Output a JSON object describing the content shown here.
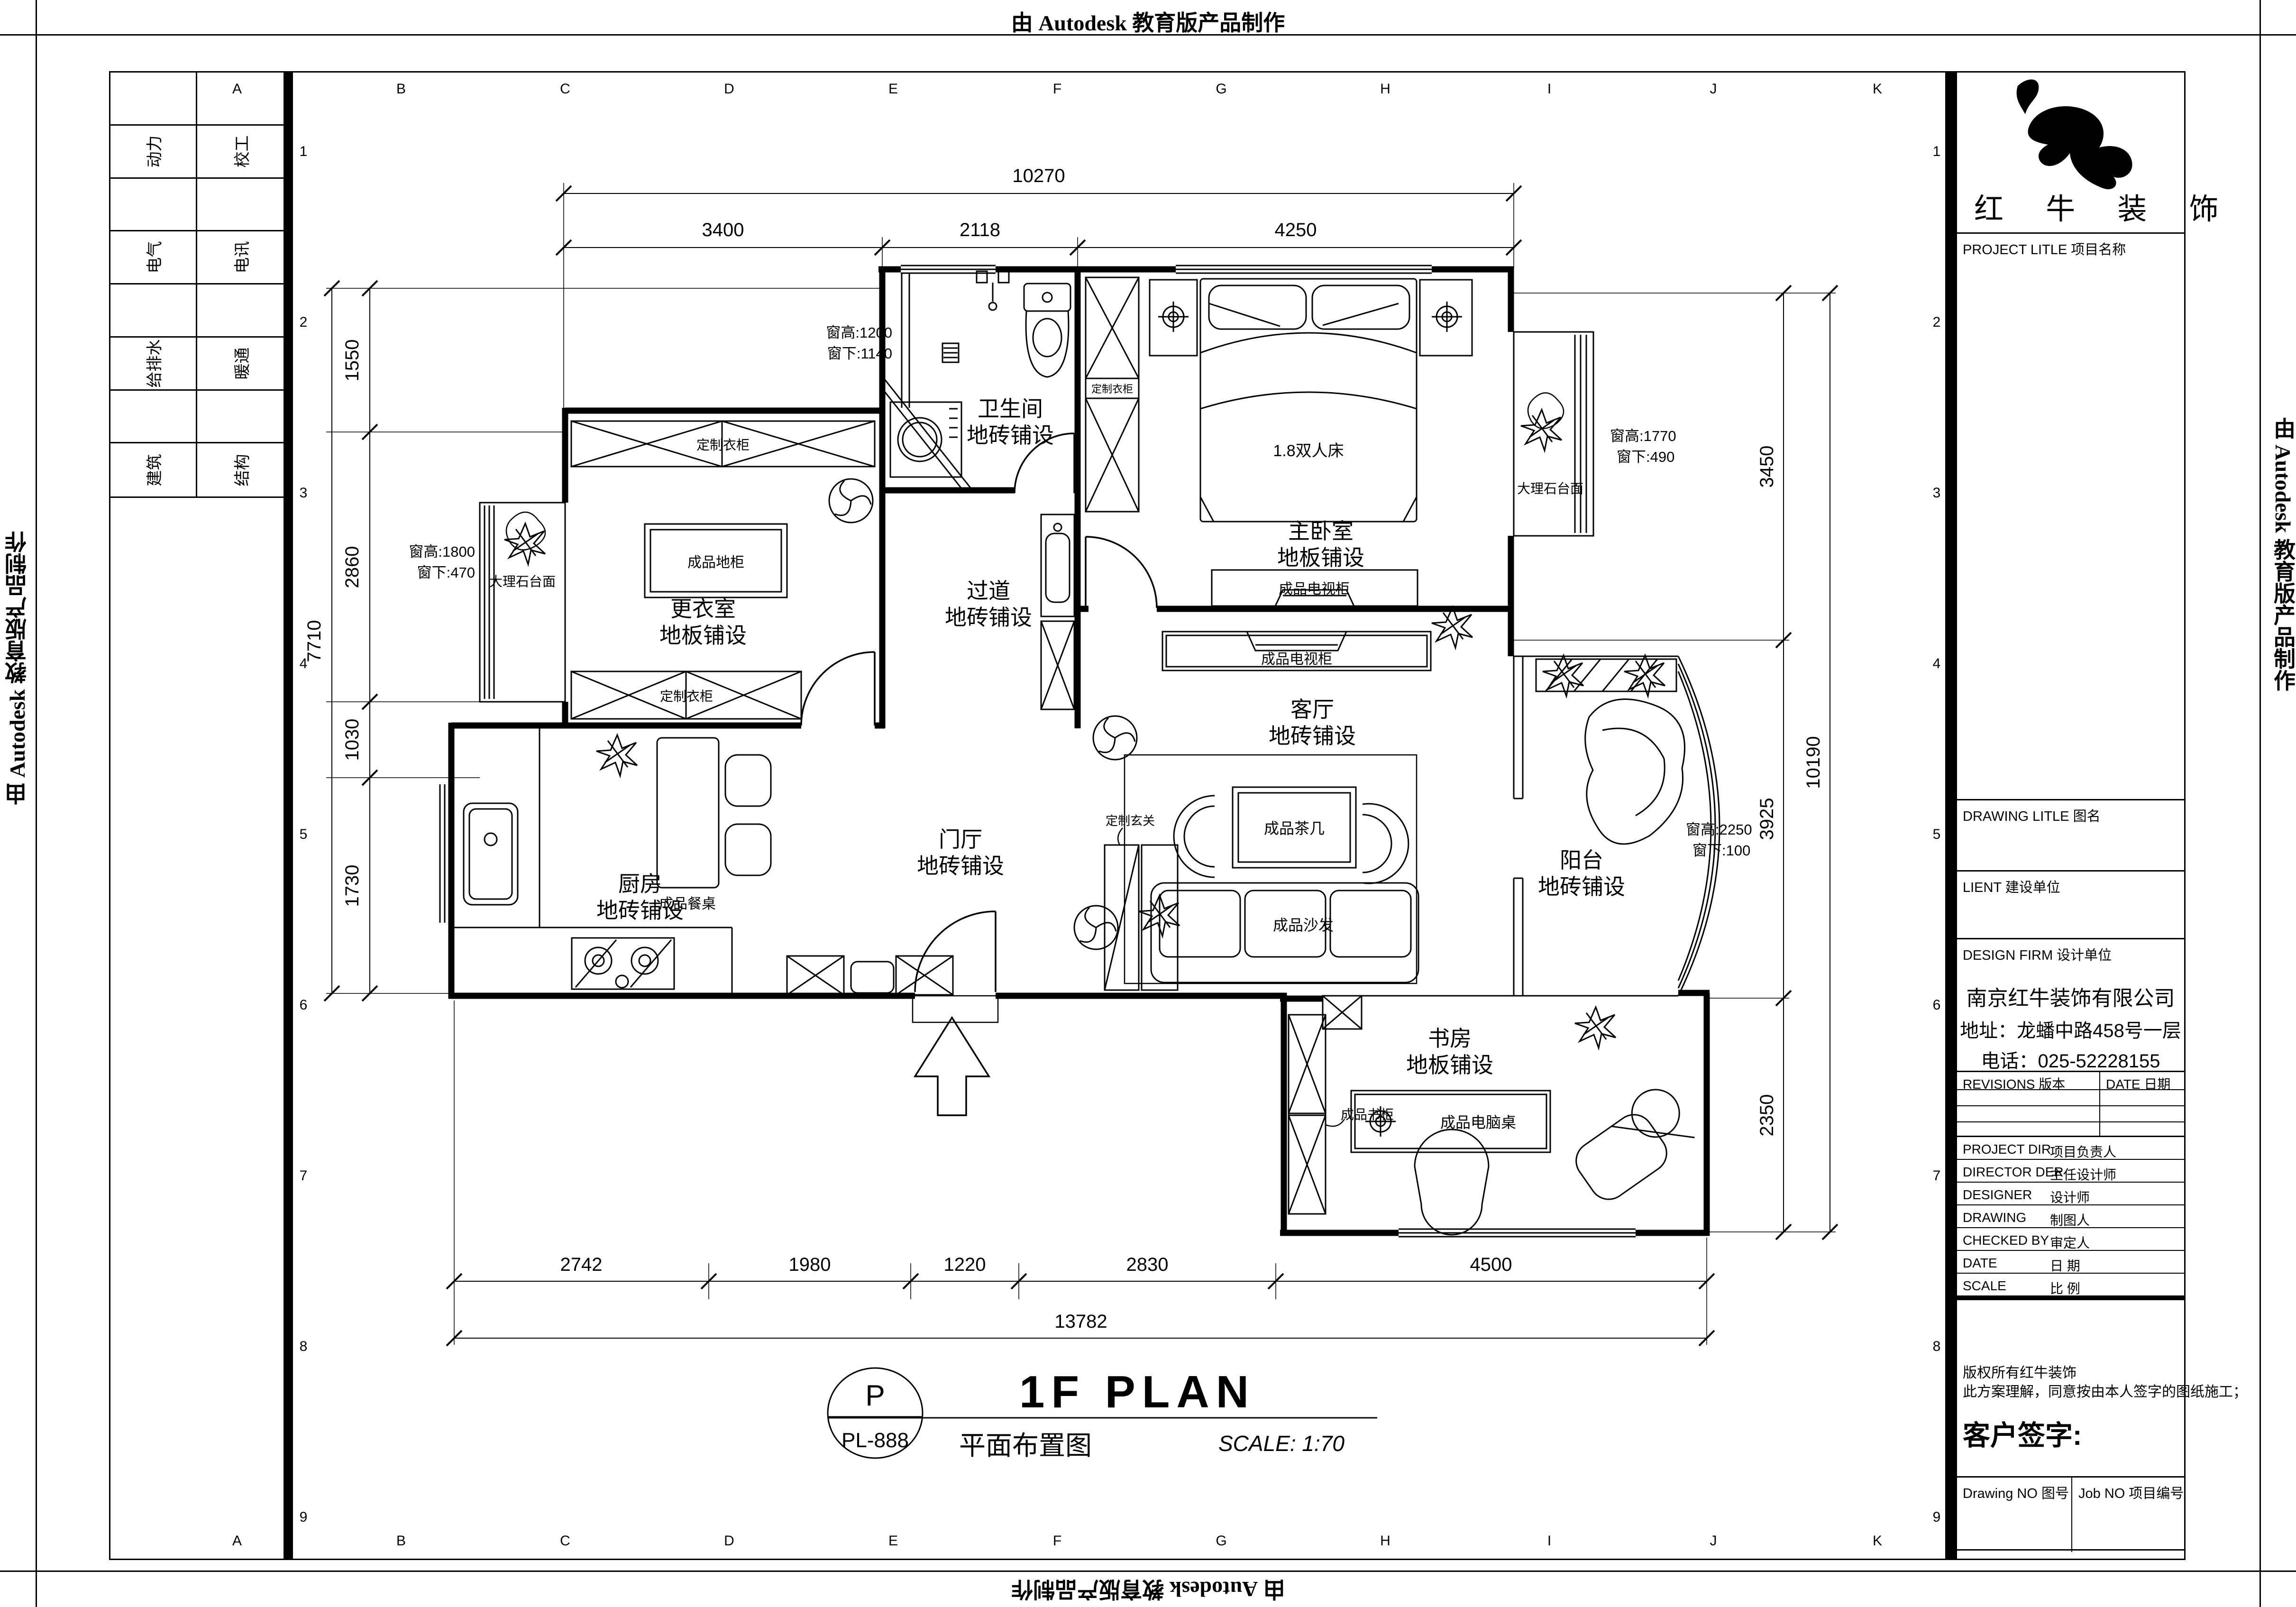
{
  "watermark": "由 Autodesk 教育版产品制作",
  "sheet": {
    "grid_letters": [
      "A",
      "B",
      "C",
      "D",
      "E",
      "F",
      "G",
      "H",
      "I",
      "J",
      "K"
    ],
    "grid_numbers": [
      "1",
      "2",
      "3",
      "4",
      "5",
      "6",
      "7",
      "8",
      "9"
    ],
    "disciplines": [
      [
        "动力",
        "校工"
      ],
      [
        "电气",
        "电讯"
      ],
      [
        "给排水",
        "暖通"
      ],
      [
        "建筑",
        "结构"
      ]
    ]
  },
  "title_block": {
    "brand": "红 牛 装 饰",
    "project_label": "PROJECT LITLE  项目名称",
    "drawing_label": "DRAWING LITLE  图名",
    "client_label": "LIENT  建设单位",
    "firm_label": "DESIGN FIRM  设计单位",
    "firm_name": "南京红牛装饰有限公司",
    "firm_addr": "地址：龙蟠中路458号一层",
    "firm_tel": "电话：025-52228155",
    "revisions_label": "REVISIONS 版本",
    "date_col_label": "DATE 日期",
    "rows": [
      {
        "en": "PROJECT DIR",
        "zh": "项目负责人"
      },
      {
        "en": "DIRECTOR DER",
        "zh": "主任设计师"
      },
      {
        "en": "DESIGNER",
        "zh": "设计师"
      },
      {
        "en": "DRAWING",
        "zh": "制图人"
      },
      {
        "en": "CHECKED BY",
        "zh": "审定人"
      },
      {
        "en": "DATE",
        "zh": "日  期"
      },
      {
        "en": "SCALE",
        "zh": "比  例"
      }
    ],
    "copyright1": "版权所有红牛装饰",
    "copyright2": "此方案理解，同意按由本人签字的图纸施工；",
    "sign_label": "客户签字:",
    "drawing_no_label": "Drawing NO  图号",
    "job_no_label": "Job NO  项目编号"
  },
  "drawing_title": {
    "bubble_letter": "P",
    "bubble_no": "PL-888",
    "title": "1F PLAN",
    "title_cn": "平面布置图",
    "scale": "SCALE:  1:70"
  },
  "plan": {
    "rooms": [
      {
        "name": "卫生间",
        "finish": "地砖铺设"
      },
      {
        "name": "主卧室",
        "finish": "地板铺设"
      },
      {
        "name": "更衣室",
        "finish": "地板铺设"
      },
      {
        "name": "过道",
        "finish": "地砖铺设"
      },
      {
        "name": "客厅",
        "finish": "地砖铺设"
      },
      {
        "name": "门厅",
        "finish": "地砖铺设"
      },
      {
        "name": "厨房",
        "finish": "地砖铺设"
      },
      {
        "name": "阳台",
        "finish": "地砖铺设"
      },
      {
        "name": "书房",
        "finish": "地板铺设"
      }
    ],
    "furniture": {
      "bed": "1.8双人床",
      "wardrobe": "定制衣柜",
      "tv_cabinet": "成品电视柜",
      "floor_cabinet": "成品地柜",
      "coffee_table": "成品茶几",
      "sofa": "成品沙发",
      "dining_table": "成品餐桌",
      "entry_cabinet": "定制玄关",
      "bookcase": "成品书柜",
      "computer_desk": "成品电脑桌",
      "marble_counter": "大理石台面"
    },
    "window_notes": [
      {
        "height": "窗高:1200",
        "sill": "窗下:1140"
      },
      {
        "height": "窗高:1800",
        "sill": "窗下:470"
      },
      {
        "height": "窗高:1770",
        "sill": "窗下:490"
      },
      {
        "height": "窗高:2250",
        "sill": "窗下:100"
      }
    ],
    "dims": {
      "top_total": "10270",
      "top_segments": [
        "3400",
        "2118",
        "4250"
      ],
      "left_total": "7710",
      "left_segments": [
        "1550",
        "2860",
        "1030",
        "1730"
      ],
      "right_total": "10190",
      "right_segments": [
        "3450",
        "3925",
        "2350"
      ],
      "bottom_total": "13782",
      "bottom_segments": [
        "2742",
        "1980",
        "1220",
        "2830",
        "4500"
      ]
    }
  }
}
